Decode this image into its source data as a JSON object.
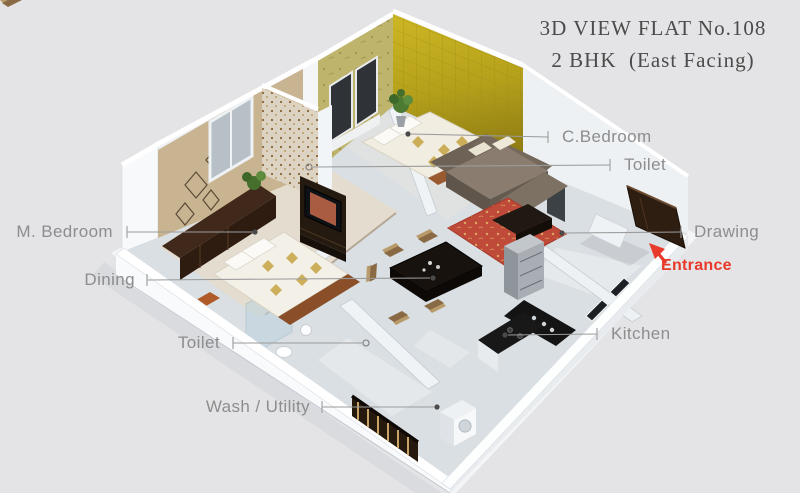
{
  "title": {
    "line1": "3D VIEW FLAT No.108",
    "line2": "2 BHK  (East Facing)"
  },
  "labels": {
    "m_bedroom": "M. Bedroom",
    "dining": "Dining",
    "toilet_bottom": "Toilet",
    "wash_utility": "Wash / Utility",
    "c_bedroom": "C.Bedroom",
    "toilet_top": "Toilet",
    "drawing": "Drawing",
    "kitchen": "Kitchen",
    "entrance": "Entrance"
  },
  "colors": {
    "background": "#e4e4e6",
    "title_text": "#4b4b4b",
    "label_text": "#8d8d8d",
    "leader_line": "#9b9b9b",
    "entrance_accent": "#e8392b",
    "accent_wall_yellow": "#c3ab1e",
    "wall_white": "#f2f4f6",
    "floor_gray": "#dadfe3",
    "carpet_red": "#bf4a3a",
    "sofa_brown": "#8a7d6f",
    "door_wood_dark": "#2e1d11"
  }
}
